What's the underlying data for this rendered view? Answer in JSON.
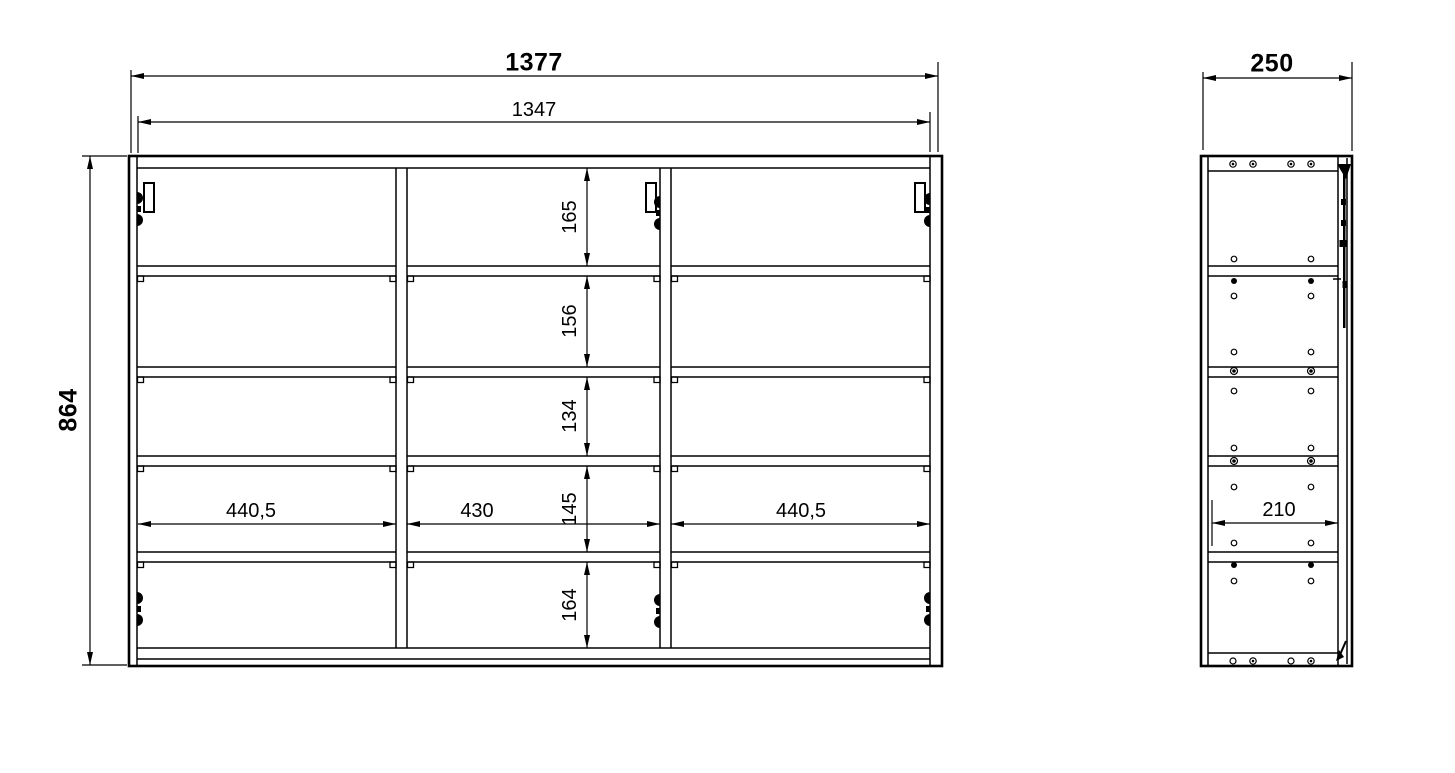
{
  "front_view": {
    "outer_width": "1377",
    "inner_width": "1347",
    "height": "864",
    "opening_heights": [
      "165",
      "156",
      "134",
      "145",
      "164"
    ],
    "compartment_widths": [
      "440,5",
      "430",
      "440,5"
    ]
  },
  "side_view": {
    "depth": "250",
    "inner_depth": "210"
  },
  "style": {
    "line_color": "#000000",
    "background": "#ffffff"
  }
}
